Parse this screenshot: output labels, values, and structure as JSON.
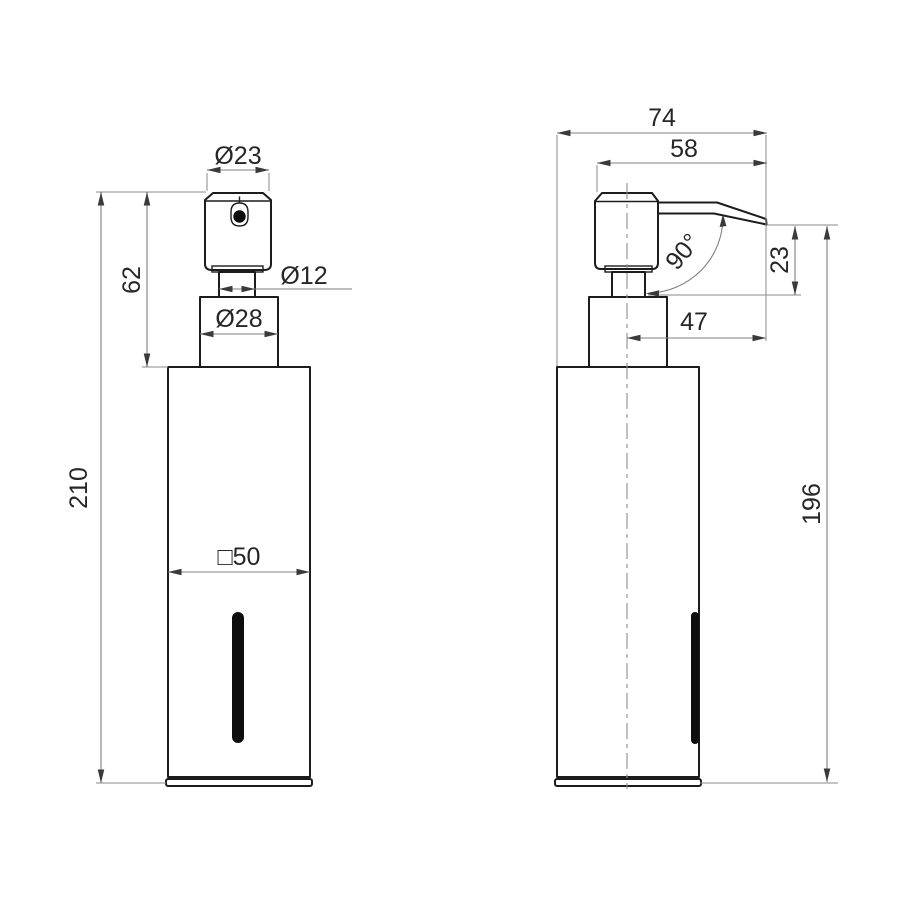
{
  "views": {
    "front": {
      "dims": {
        "head_diameter": "Ø23",
        "pump_height": "62",
        "neck_diameter": "Ø12",
        "collar_diameter": "Ø28",
        "overall_height": "210",
        "body_width_square": "□50"
      }
    },
    "side": {
      "dims": {
        "overall_depth": "74",
        "spout_reach": "58",
        "spout_angle": "90°",
        "spout_drop": "23",
        "spout_projection": "47",
        "body_height": "196"
      }
    }
  },
  "colors": {
    "background": "#ffffff",
    "object_line": "#1c1c1c",
    "dimension_line": "#7f7f7f",
    "text": "#262626",
    "window_slot": "#0e0e0e"
  }
}
